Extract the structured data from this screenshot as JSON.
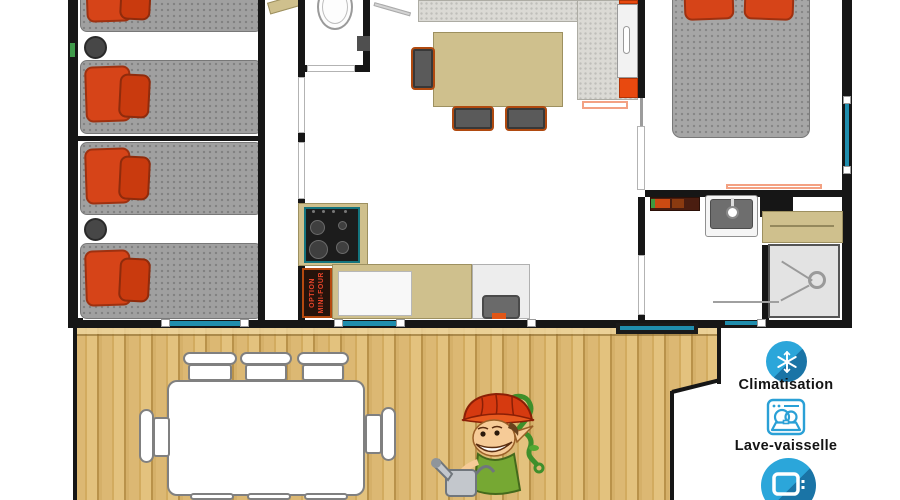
{
  "plan": {
    "oven": {
      "line1": "OPTION",
      "line2": "MINI-FOUR"
    }
  },
  "amenities": {
    "items": [
      {
        "icon": "snowflake-icon",
        "label": "Climatisation"
      },
      {
        "icon": "dishwasher-icon",
        "label": "Lave-vaisselle"
      },
      {
        "icon": "tv-icon",
        "label": ""
      }
    ]
  },
  "colors": {
    "accent_blue": "#29A3D8",
    "accent_blue_shadow": "#1A74A6",
    "wall": "#161616",
    "window_teal": "#1F8DAD",
    "pillow_orange": "#D64418",
    "mattress_gray": "#A0A0A0",
    "counter_tan": "#CFC08D",
    "deck_wood": "#D8B469"
  }
}
